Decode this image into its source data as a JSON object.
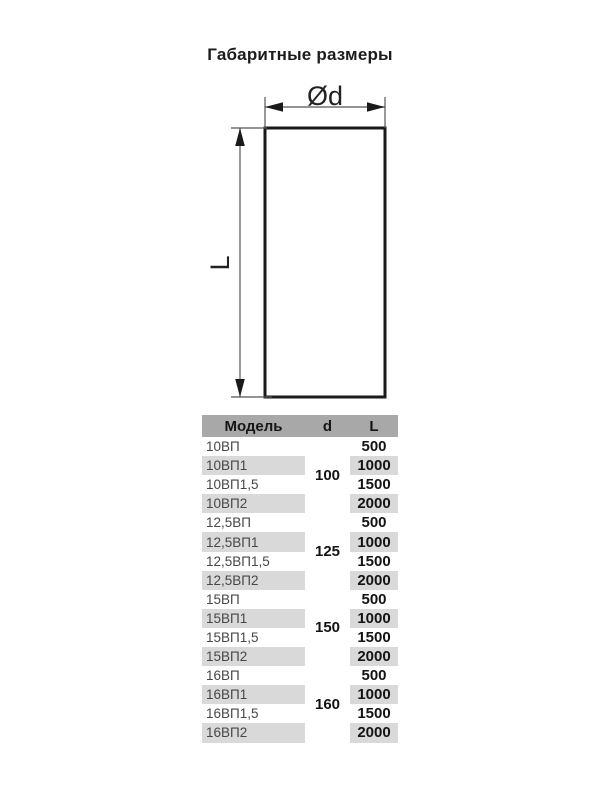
{
  "title": "Габаритные размеры",
  "diagram": {
    "diameter_label": "Ød",
    "length_label": "L"
  },
  "table": {
    "headers": {
      "model": "Модель",
      "d": "d",
      "l": "L"
    },
    "groups": [
      {
        "d": "100",
        "rows": [
          {
            "model": "10ВП",
            "l": "500"
          },
          {
            "model": "10ВП1",
            "l": "1000"
          },
          {
            "model": "10ВП1,5",
            "l": "1500"
          },
          {
            "model": "10ВП2",
            "l": "2000"
          }
        ]
      },
      {
        "d": "125",
        "rows": [
          {
            "model": "12,5ВП",
            "l": "500"
          },
          {
            "model": "12,5ВП1",
            "l": "1000"
          },
          {
            "model": "12,5ВП1,5",
            "l": "1500"
          },
          {
            "model": "12,5ВП2",
            "l": "2000"
          }
        ]
      },
      {
        "d": "150",
        "rows": [
          {
            "model": "15ВП",
            "l": "500"
          },
          {
            "model": "15ВП1",
            "l": "1000"
          },
          {
            "model": "15ВП1,5",
            "l": "1500"
          },
          {
            "model": "15ВП2",
            "l": "2000"
          }
        ]
      },
      {
        "d": "160",
        "rows": [
          {
            "model": "16ВП",
            "l": "500"
          },
          {
            "model": "16ВП1",
            "l": "1000"
          },
          {
            "model": "16ВП1,5",
            "l": "1500"
          },
          {
            "model": "16ВП2",
            "l": "2000"
          }
        ]
      }
    ]
  },
  "colors": {
    "header_bg": "#a8a8a8",
    "row_shaded_bg": "#d9d9d9",
    "outline": "#1a1a1a",
    "dim_line": "#555555"
  }
}
